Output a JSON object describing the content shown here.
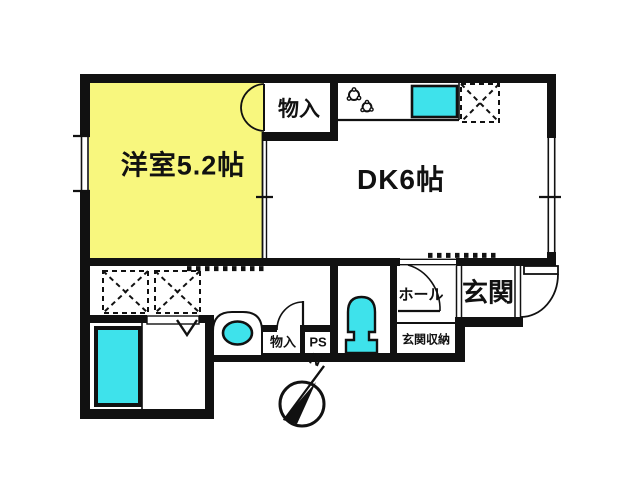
{
  "figure_type": "apartment-floor-plan",
  "rooms": {
    "western_room": "洋室5.2帖",
    "dk": "DK6帖",
    "closet_top": "物入",
    "closet_bottom": "物入",
    "pipe_space": "PS",
    "hall": "ホール",
    "entrance": "玄関",
    "entrance_storage": "玄関収納"
  },
  "compass": {
    "north": "N"
  },
  "fixtures": [
    "stove-burners",
    "kitchen-sink",
    "refrigerator-space",
    "washing-machine-space-1",
    "washing-machine-space-2",
    "bathtub",
    "bath-folding-door",
    "washbasin",
    "toilet",
    "closet-double-doors",
    "hall-door",
    "lavatory-door",
    "front-door",
    "window-left",
    "window-right",
    "compass-north"
  ],
  "colors": {
    "room-yellow": "#F8F77E",
    "fixture-cyan": "#3EE2EB",
    "line": "#111111",
    "bg": "#FFFFFF"
  }
}
